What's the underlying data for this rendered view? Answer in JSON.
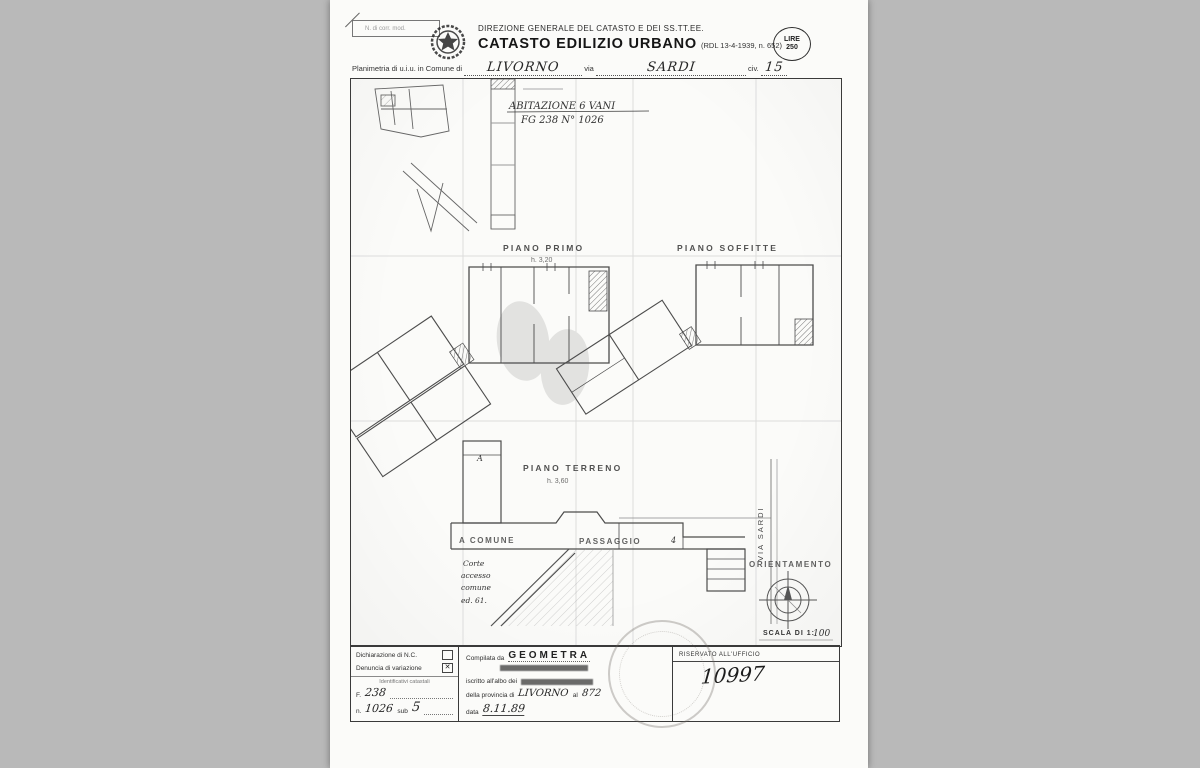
{
  "header": {
    "corner_note": "N. di corr. mod.",
    "agency": "DIREZIONE GENERALE DEL CATASTO E DEI SS.TT.EE.",
    "title": "CATASTO EDILIZIO URBANO",
    "title_ref": "(RDL 13-4-1939, n. 652)",
    "stamp_line1": "LIRE",
    "stamp_line2": "250",
    "form": {
      "prefix": "Planimetria di u.i.u. in Comune di",
      "comune": "LIVORNO",
      "via_label": "via",
      "via": "SARDI",
      "civ_label": "civ.",
      "civ": "15"
    }
  },
  "plan": {
    "note1": "ABITAZIONE 6 VANI",
    "note2": "FG 238 N° 1026",
    "floor1_label": "PIANO PRIMO",
    "floor1_h": "h. 3,20",
    "floor2_label": "PIANO SOFFITTE",
    "floor3_label": "PIANO TERRENO",
    "floor3_h": "h. 3,60",
    "room_a": "A",
    "a_comune": "A COMUNE",
    "passaggio": "PASSAGGIO",
    "dim4": "4",
    "corte1": "Corte",
    "corte2": "accesso",
    "corte3": "comune",
    "corte4": "ed. 61.",
    "via_sardi": "VIA SARDI",
    "orientamento": "ORIENTAMENTO",
    "scala_label": "SCALA DI 1:",
    "scala_value": "100"
  },
  "footer": {
    "decl_nc": "Dichiarazione di N.C.",
    "decl_var": "Denuncia di variazione",
    "check_nc": "",
    "check_var": "✕",
    "catastali": "Identificativi catastali",
    "f_label": "F.",
    "f_value": "238",
    "n_label": "n.",
    "n_value": "1026",
    "sub_label": "sub",
    "sub_value": "5",
    "compilata_label": "Compilata da",
    "compilata_value": "GEOMETRA",
    "albo_label": "iscritto all'albo dei",
    "prov_label": "della provincia di",
    "prov_value": "LIVORNO",
    "al_label": "al",
    "al_value": "872",
    "data_label": "data",
    "data_value": "8.11.89",
    "ufficio_title": "RISERVATO ALL'UFFICIO",
    "protocol": "10997"
  }
}
